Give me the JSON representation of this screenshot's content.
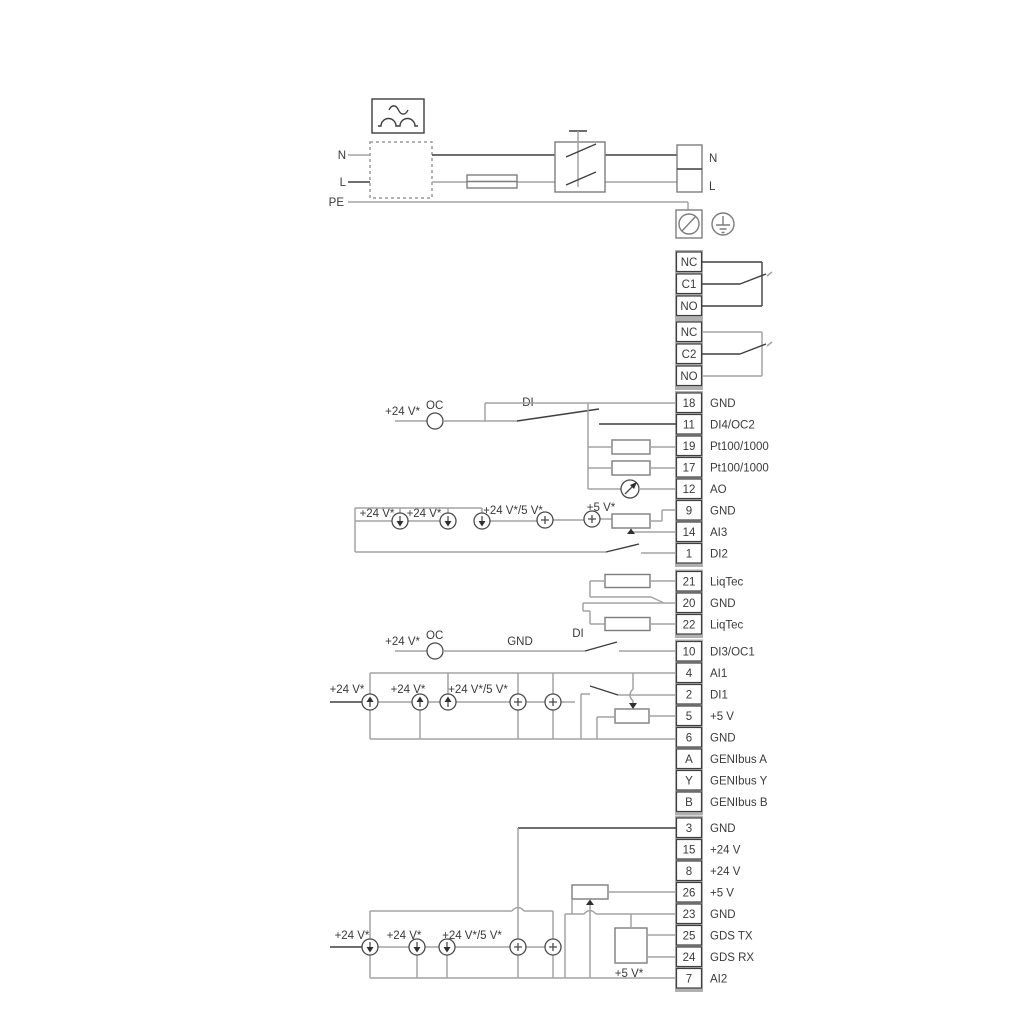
{
  "diagram_title": "pump-drive-wiring-diagram",
  "power": {
    "n_left": "N",
    "l_left": "L",
    "pe": "PE",
    "n_right": "N",
    "l_right": "L"
  },
  "relays": [
    {
      "cells": [
        "NC",
        "C1",
        "NO"
      ]
    },
    {
      "cells": [
        "NC",
        "C2",
        "NO"
      ]
    }
  ],
  "terminals": [
    {
      "id": "18",
      "label": "GND"
    },
    {
      "id": "11",
      "label": "DI4/OC2"
    },
    {
      "id": "19",
      "label": "Pt100/1000"
    },
    {
      "id": "17",
      "label": "Pt100/1000"
    },
    {
      "id": "12",
      "label": "AO"
    },
    {
      "id": "9",
      "label": "GND"
    },
    {
      "id": "14",
      "label": "AI3"
    },
    {
      "id": "1",
      "label": "DI2"
    },
    {
      "id": "21",
      "label": "LiqTec"
    },
    {
      "id": "20",
      "label": "GND"
    },
    {
      "id": "22",
      "label": "LiqTec"
    },
    {
      "id": "10",
      "label": "DI3/OC1"
    },
    {
      "id": "4",
      "label": "AI1"
    },
    {
      "id": "2",
      "label": "DI1"
    },
    {
      "id": "5",
      "label": "+5 V"
    },
    {
      "id": "6",
      "label": "GND"
    },
    {
      "id": "A",
      "label": "GENIbus A"
    },
    {
      "id": "Y",
      "label": "GENIbus Y"
    },
    {
      "id": "B",
      "label": "GENIbus B"
    },
    {
      "id": "3",
      "label": "GND"
    },
    {
      "id": "15",
      "label": "+24 V"
    },
    {
      "id": "8",
      "label": "+24 V"
    },
    {
      "id": "26",
      "label": "+5 V"
    },
    {
      "id": "23",
      "label": "GND"
    },
    {
      "id": "25",
      "label": "GDS TX"
    },
    {
      "id": "24",
      "label": "GDS RX"
    },
    {
      "id": "7",
      "label": "AI2"
    }
  ],
  "labels": {
    "oc": "OC",
    "di": "DI",
    "gnd": "GND",
    "v24": "+24 V*",
    "v24_5": "+24 V*/5 V*",
    "v5": "+5 V*"
  },
  "colors": {
    "wire_gray": "#a3a3a3",
    "wire_dark": "#3f3f3f",
    "component_gray": "#7d7d7d",
    "terminal_backing": "#b0b0b0",
    "text": "#3a3a3a",
    "background": "#ffffff"
  }
}
